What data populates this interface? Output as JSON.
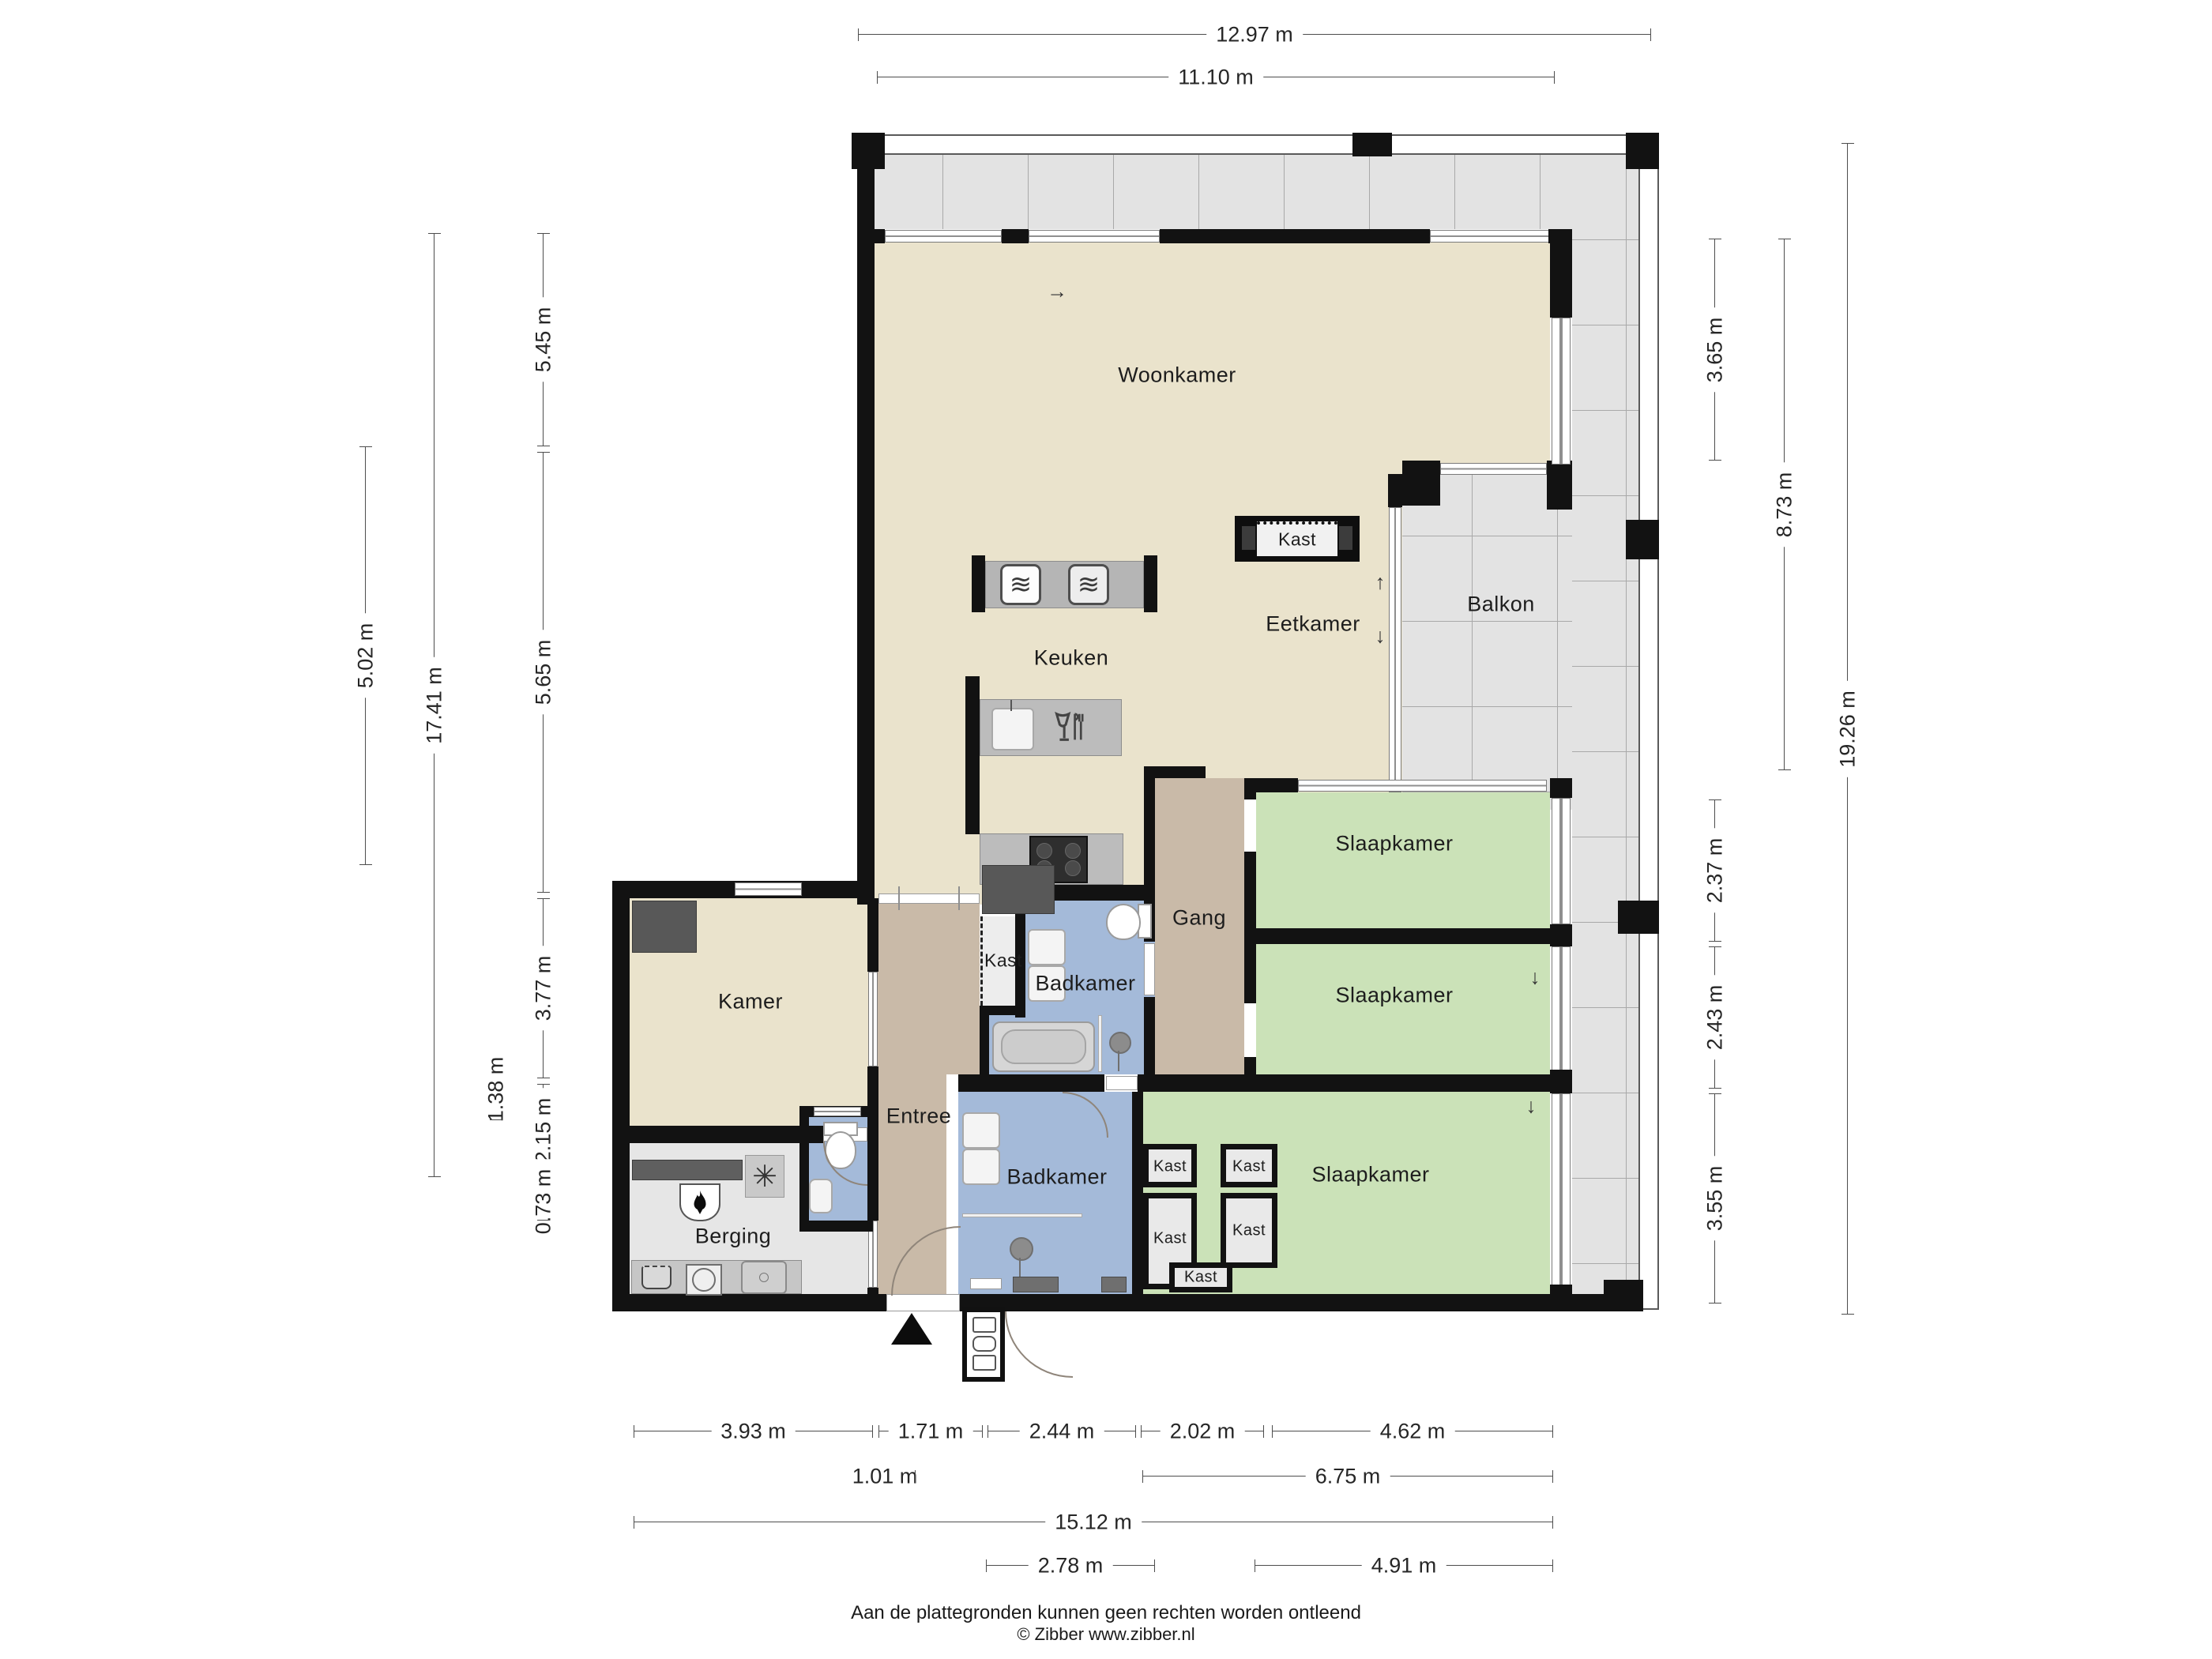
{
  "rooms": {
    "woonkamer": "Woonkamer",
    "eetkamer": "Eetkamer",
    "keuken": "Keuken",
    "balkon": "Balkon",
    "gang": "Gang",
    "slaapkamer": "Slaapkamer",
    "badkamer": "Badkamer",
    "kamer": "Kamer",
    "entree": "Entree",
    "berging": "Berging",
    "kast": "Kast"
  },
  "dimensions": {
    "top": [
      "12.97 m",
      "11.10 m"
    ],
    "left": [
      "5.45 m",
      "5.65 m",
      "3.77 m",
      "2.15 m",
      "0.73 m",
      "1.38 m",
      "17.41 m",
      "5.02 m"
    ],
    "right": [
      "3.65 m",
      "2.37 m",
      "2.43 m",
      "3.55 m",
      "8.73 m",
      "19.26 m"
    ],
    "bottom": [
      "3.93 m",
      "1.71 m",
      "2.44 m",
      "2.02 m",
      "4.62 m",
      "1.01 m",
      "6.75 m",
      "15.12 m",
      "2.78 m",
      "4.91 m"
    ]
  },
  "icons": {
    "oven": "≋",
    "fan": "✳",
    "arrow_right": "→",
    "arrow_up": "↑",
    "arrow_down": "↓"
  },
  "footer": {
    "disclaimer": "Aan de plattegronden kunnen geen rechten worden ontleend",
    "credit": "© Zibber www.zibber.nl"
  },
  "colors": {
    "living": "#eae3cc",
    "bedroom": "#cbe2b8",
    "bathroom": "#a4bad9",
    "hallway": "#c9baa8",
    "storage": "#e6e6e6",
    "balcony_tile": "#e3e3e3",
    "wall": "#121212"
  }
}
